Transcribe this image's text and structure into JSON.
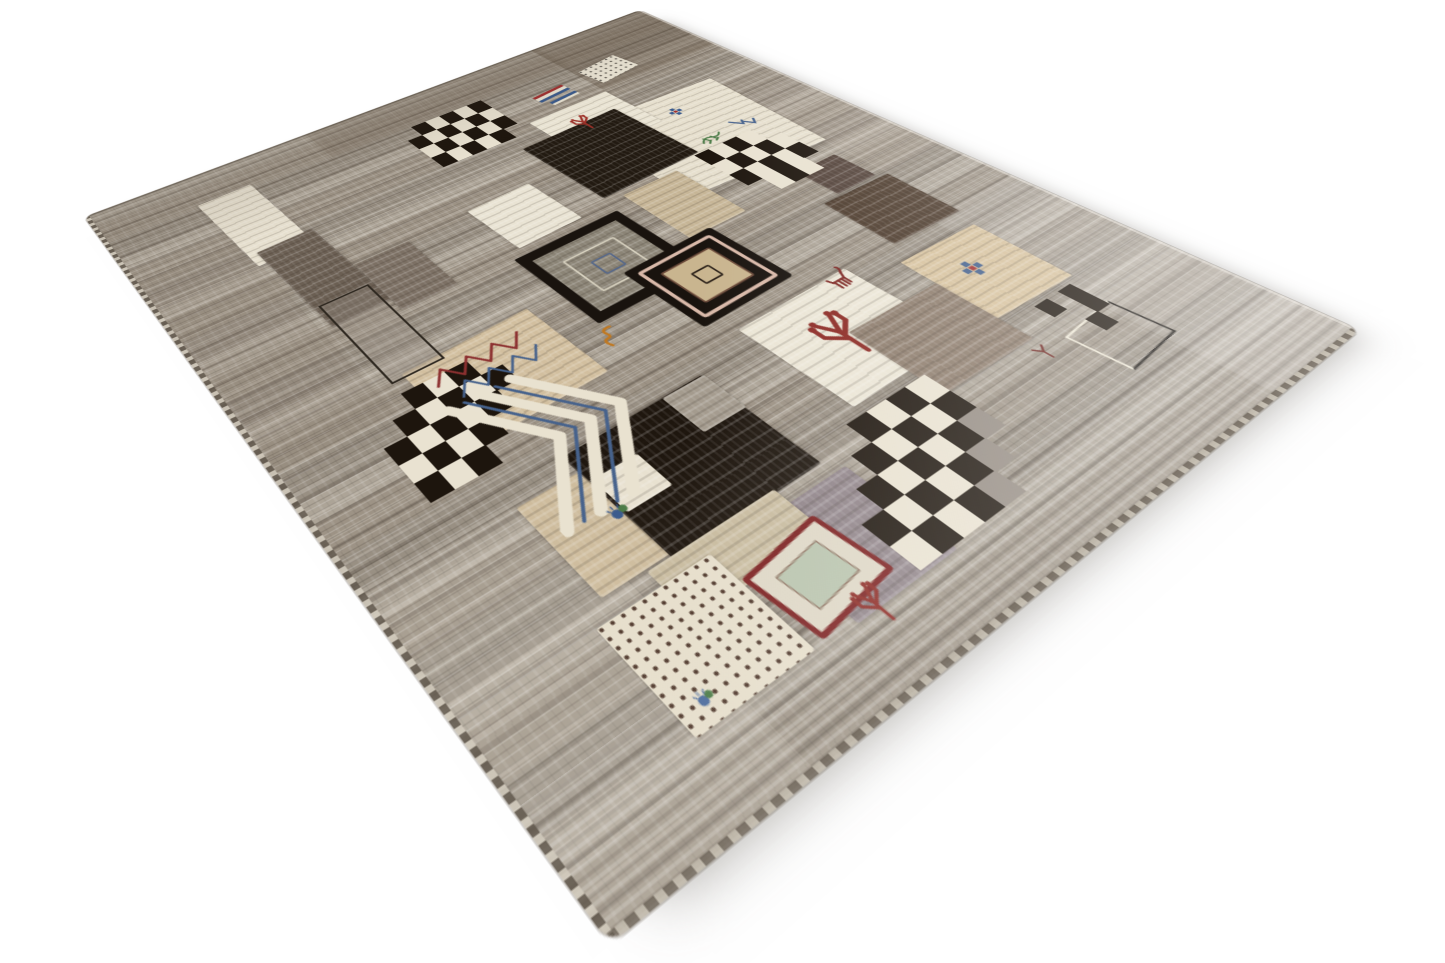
{
  "scene": {
    "subject": "Product photograph of a hand-woven grey Gabbeh-style wool rug with tribal patchwork design, shown at an angle on a plain white background",
    "background_color": "#ffffff",
    "image_width": 1445,
    "image_height": 963
  },
  "rug": {
    "plane": {
      "width": 760,
      "height": 840,
      "matrix3d": [
        0.961825,
        -0.26877,
        0,
        0.00035976,
        0.24774,
        0.28038,
        0,
        -0.00062041,
        0,
        0,
        1,
        0,
        84,
        217,
        0,
        1
      ],
      "corners_in_image": {
        "top": [
          640,
          10
        ],
        "left": [
          84,
          217
        ],
        "bottom": [
          610,
          945
        ],
        "right": [
          1360,
          330
        ]
      }
    },
    "palette": {
      "base_grey": "#a49b8e",
      "stripe_dark": "#6f6559",
      "stripe_light": "#d5cec0",
      "cream": "#ebe5d5",
      "tan": "#d2bf9f",
      "beige": "#d6c19c",
      "black_brown": "#1e160e",
      "taupe": "#6b5f53",
      "maroon_red": "#8c2a24",
      "dark_red_frame": "#7c2020",
      "blue": "#44608c",
      "green": "#4a7a46",
      "orange": "#c07820",
      "pink_frame": "#d9b9a9"
    },
    "checker_colors": {
      "d": "#1d150d",
      "l": "#e9e2d1",
      "g": "#948b82"
    },
    "layers": [
      {
        "id": "tone-top-corner",
        "k": "tone",
        "x": 580,
        "y": 0,
        "w": 180,
        "h": 140,
        "c": "rgba(88,72,57,0.30)"
      },
      {
        "id": "tone-top-band",
        "k": "tone",
        "x": 260,
        "y": 0,
        "w": 330,
        "h": 66,
        "c": "rgba(104,90,76,0.20)"
      },
      {
        "id": "tone-left-band",
        "k": "tone",
        "x": 0,
        "y": 150,
        "w": 110,
        "h": 300,
        "c": "rgba(126,112,96,0.14)"
      },
      {
        "id": "tone-bottom-left",
        "k": "tone",
        "x": 0,
        "y": 600,
        "w": 150,
        "h": 240,
        "c": "rgba(230,224,212,0.16)"
      },
      {
        "id": "tone-right-low",
        "k": "tone",
        "x": 640,
        "y": 540,
        "w": 120,
        "h": 300,
        "c": "rgba(233,229,219,0.18)"
      },
      {
        "id": "tone-mid-right",
        "k": "tone",
        "x": 676,
        "y": 260,
        "w": 84,
        "h": 200,
        "c": "rgba(196,186,170,0.14)"
      },
      {
        "id": "patch-cream-right",
        "k": "solid",
        "x": 500,
        "y": 196,
        "w": 186,
        "h": 180,
        "c": "#e6dfcd",
        "r": 3
      },
      {
        "id": "patch-cream-left",
        "k": "solid",
        "x": 105,
        "y": 58,
        "w": 62,
        "h": 140,
        "c": "#e7e0cf",
        "r": -2
      },
      {
        "id": "patch-taupe-left",
        "k": "solid",
        "x": 118,
        "y": 176,
        "w": 62,
        "h": 148,
        "c": "#6b5f53",
        "r": -2
      },
      {
        "id": "patch-taupe-left2",
        "k": "solid",
        "x": 181,
        "y": 256,
        "w": 60,
        "h": 86,
        "c": "#7c7064"
      },
      {
        "id": "patch-white-mid",
        "k": "solid",
        "x": 315,
        "y": 248,
        "w": 78,
        "h": 84,
        "c": "#e9e3d3",
        "r": -2
      },
      {
        "id": "patch-cream-top",
        "k": "solid",
        "x": 468,
        "y": 146,
        "w": 112,
        "h": 94,
        "c": "#e9e3d2",
        "r": -1
      },
      {
        "id": "patch-black-top",
        "k": "solid",
        "x": 430,
        "y": 186,
        "w": 132,
        "h": 130,
        "c": "#221a11",
        "r": -2
      },
      {
        "id": "patch-tan-mid",
        "k": "solid",
        "x": 450,
        "y": 326,
        "w": 72,
        "h": 96,
        "c": "#c6b596"
      },
      {
        "id": "patch-brown-small",
        "k": "solid",
        "x": 610,
        "y": 406,
        "w": 54,
        "h": 52,
        "c": "#54433a"
      },
      {
        "id": "patch-brown-sq",
        "k": "solid",
        "x": 585,
        "y": 462,
        "w": 88,
        "h": 84,
        "c": "#4c3a2b",
        "r": 2
      },
      {
        "id": "patch-tan-zigzag",
        "k": "solid",
        "x": 138,
        "y": 412,
        "w": 132,
        "h": 106,
        "c": "#d2bf9f",
        "r": -2
      },
      {
        "id": "patch-tan-low",
        "k": "solid",
        "x": 128,
        "y": 586,
        "w": 112,
        "h": 94,
        "c": "#cebc9d"
      },
      {
        "id": "patch-black-low",
        "k": "solid",
        "x": 185,
        "y": 566,
        "w": 142,
        "h": 120,
        "c": "#1e160e",
        "r": -1
      },
      {
        "id": "patch-black-low-notch",
        "k": "solid",
        "x": 284,
        "y": 566,
        "w": 44,
        "h": 46,
        "c": "#a49b8e"
      },
      {
        "id": "patch-cream-tree",
        "k": "solid",
        "x": 390,
        "y": 542,
        "w": 132,
        "h": 118,
        "c": "#ebe5d5",
        "r": -1
      },
      {
        "id": "patch-beige-cross",
        "k": "solid",
        "x": 563,
        "y": 567,
        "w": 98,
        "h": 98,
        "c": "#d6c19c",
        "r": 2
      },
      {
        "id": "patch-brown-mid",
        "k": "solid",
        "x": 455,
        "y": 602,
        "w": 108,
        "h": 92,
        "c": "#8c7b6b",
        "r": 1
      },
      {
        "id": "patch-mauve-low",
        "k": "solid",
        "x": 243,
        "y": 697,
        "w": 96,
        "h": 92,
        "c": "#8f8388"
      },
      {
        "id": "patch-beige-strip",
        "k": "solid",
        "x": 165,
        "y": 682,
        "w": 118,
        "h": 46,
        "c": "#c8bb9f"
      },
      {
        "id": "patch-white-mini",
        "k": "solid",
        "x": 188,
        "y": 598,
        "w": 42,
        "h": 38,
        "c": "#e8e1d0"
      },
      {
        "id": "patch-speckle-low",
        "k": "speckle",
        "x": 110,
        "y": 696,
        "w": 98,
        "h": 90,
        "c": "#e6decb",
        "c2": "#4a3226"
      },
      {
        "id": "patch-speckle-top",
        "k": "speckle",
        "x": 588,
        "y": 82,
        "w": 62,
        "h": 42,
        "c": "#ece6d6",
        "c2": "#55504a",
        "r": -8
      },
      {
        "id": "patch-outline-left",
        "k": "outline",
        "x": 124,
        "y": 290,
        "w": 48,
        "h": 126,
        "b": "#2e2820",
        "c": "rgba(158,150,138,0.30)"
      },
      {
        "id": "patch-outline-right",
        "k": "whiteframe",
        "x": 584,
        "y": 706,
        "w": 64,
        "h": 50,
        "b": "#efe9d7",
        "c2": "#14100c",
        "r": -5
      },
      {
        "id": "patch-redframe",
        "k": "redframe",
        "x": 213,
        "y": 718,
        "w": 70,
        "h": 54,
        "b": "#7c2020",
        "c": "#ded7c6",
        "c2": "#b9c4ae",
        "r": -7
      },
      {
        "id": "medallion-left",
        "k": "medallion1",
        "x": 303,
        "y": 344,
        "w": 102,
        "h": 96,
        "c": "#19130e",
        "c2": "#8b8476",
        "b": "#d8d2c0",
        "r": -1
      },
      {
        "id": "medallion-right",
        "k": "medallion2",
        "x": 368,
        "y": 422,
        "w": 110,
        "h": 100,
        "c": "#19130e",
        "c2": "#d9b9a9",
        "c3": "#c9b58f",
        "b": "#6b4a3a",
        "r": -2
      },
      {
        "id": "checkerboard-top-left",
        "k": "checker",
        "x": 342,
        "y": 66,
        "cw": 19,
        "ch": 24,
        "rows": [
          ".dldld",
          "dldldl",
          "ldldld",
          "dldld."
        ]
      },
      {
        "id": "checkerboard-top-right",
        "k": "checker",
        "x": 556,
        "y": 316,
        "cw": 20,
        "ch": 25,
        "rows": [
          "dldl.",
          "ldldl",
          "dldld",
          ".ldl."
        ]
      },
      {
        "id": "checkerboard-mid-left",
        "k": "checker",
        "x": 82,
        "y": 434,
        "cw": 21,
        "ch": 22,
        "rows": [
          "..dld.",
          ".dldld",
          "dldld.",
          "ldld..",
          "dld..."
        ]
      },
      {
        "id": "checkerboard-bottom",
        "k": "checker",
        "x": 306,
        "y": 670,
        "cw": 22,
        "ch": 23,
        "rows": [
          "...dldl",
          "..dldld",
          ".dldldg",
          "dldldg.",
          "ldldg.."
        ]
      },
      {
        "id": "checkerboard-right-tiny",
        "k": "checker",
        "x": 598,
        "y": 672,
        "cw": 16,
        "ch": 17,
        "rows": [
          "d.d",
          "..d",
          ".d."
        ]
      },
      {
        "id": "motif-flag-stripes",
        "k": "bars",
        "x": 506,
        "y": 100,
        "w": 46,
        "h": 16,
        "colors": [
          "#a03030",
          "#e8e2d2",
          "#3a5a8c"
        ],
        "r": -6
      },
      {
        "id": "motif-flag-stripes-2",
        "k": "bars",
        "x": 514,
        "y": 122,
        "w": 40,
        "h": 9,
        "colors": [
          "#3a5a8c",
          "#e8e2d2"
        ],
        "r": -6
      },
      {
        "id": "motif-chevrons",
        "k": "chevrons",
        "x": 140,
        "y": 468,
        "w": 130,
        "h": 162,
        "c": "#e9e2d0",
        "c2": "#46628c"
      },
      {
        "id": "motif-zigzag-red",
        "k": "motif",
        "t": "zigzag",
        "x": 150,
        "y": 424,
        "s": 104,
        "c": "#8c3030"
      },
      {
        "id": "motif-zigzag-blue",
        "k": "motif",
        "t": "zigzag",
        "x": 160,
        "y": 448,
        "s": 96,
        "c": "#46628c"
      },
      {
        "id": "motif-tree-main",
        "k": "motif",
        "t": "branch",
        "x": 420,
        "y": 568,
        "s": 62,
        "c": "#8c2a24"
      },
      {
        "id": "motif-tree-top",
        "k": "motif",
        "t": "branch",
        "x": 496,
        "y": 168,
        "s": 36,
        "c": "#9c3028"
      },
      {
        "id": "motif-tree-bottom",
        "k": "motif",
        "t": "branch",
        "x": 246,
        "y": 768,
        "s": 34,
        "c": "#8c2a24"
      },
      {
        "id": "motif-goat",
        "k": "motif",
        "t": "goat",
        "x": 492,
        "y": 532,
        "s": 32,
        "c": "#7c2420"
      },
      {
        "id": "motif-lizard",
        "k": "motif",
        "t": "lizard",
        "x": 578,
        "y": 286,
        "s": 34,
        "c": "#4a7a46"
      },
      {
        "id": "motif-bird-v",
        "k": "motif",
        "t": "vbird",
        "x": 630,
        "y": 284,
        "s": 32,
        "c": "#44608c"
      },
      {
        "id": "motif-flower-top",
        "k": "motif",
        "t": "flower",
        "x": 596,
        "y": 224,
        "s": 20,
        "c": "#3a5a8c",
        "c2": "#a03030"
      },
      {
        "id": "motif-flower-beige",
        "k": "motif",
        "t": "flower",
        "x": 592,
        "y": 596,
        "s": 26,
        "c": "#44608c",
        "c2": "#a03030"
      },
      {
        "id": "motif-beetle",
        "k": "motif",
        "t": "beetle",
        "x": 174,
        "y": 622,
        "s": 22,
        "c": "#3a5a8c",
        "c2": "#4a7a46"
      },
      {
        "id": "motif-s-figure",
        "k": "motif",
        "t": "sfig",
        "x": 290,
        "y": 470,
        "s": 28,
        "c": "#c07820"
      },
      {
        "id": "motif-y-mark",
        "k": "motif",
        "t": "ymark",
        "x": 544,
        "y": 700,
        "s": 20,
        "c": "#6b1f1a"
      },
      {
        "id": "motif-tiny-figure",
        "k": "motif",
        "t": "beetle",
        "x": 124,
        "y": 762,
        "s": 18,
        "c": "#4a6a9c",
        "c2": "#4a7a46"
      }
    ]
  }
}
